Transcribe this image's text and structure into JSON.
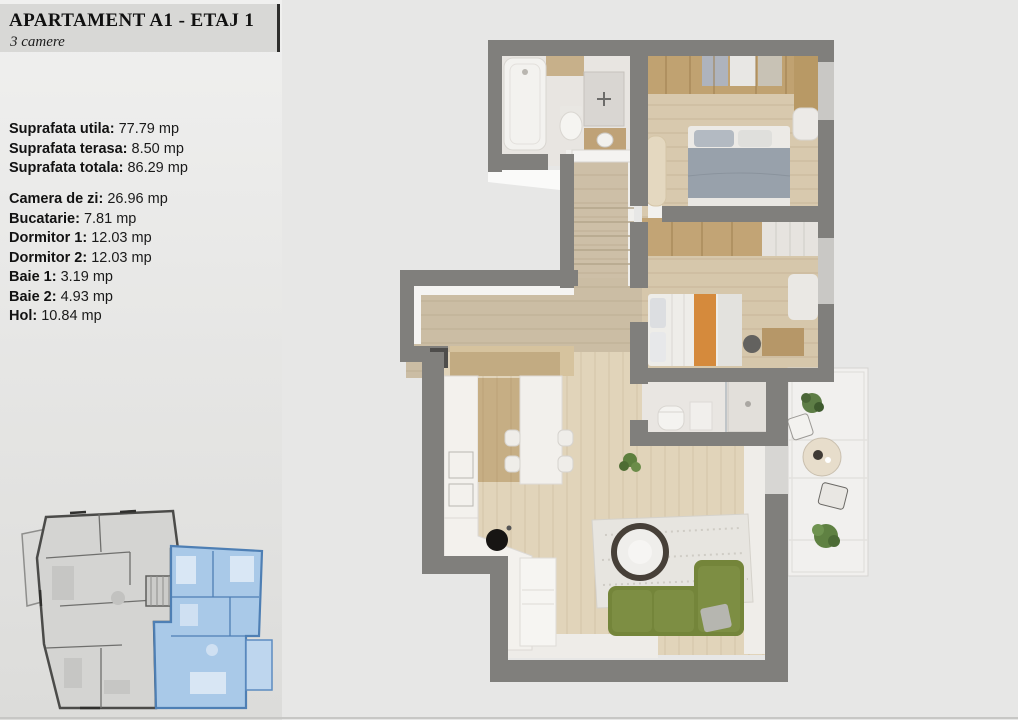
{
  "header": {
    "title": "APARTAMENT A1 - ETAJ 1",
    "subtitle": "3 camere"
  },
  "areas": {
    "summary": [
      {
        "label": "Suprafata utila:",
        "value": "77.79 mp"
      },
      {
        "label": "Suprafata terasa:",
        "value": "8.50 mp"
      },
      {
        "label": "Suprafata totala:",
        "value": "86.29 mp"
      }
    ],
    "rooms": [
      {
        "label": "Camera de zi:",
        "value": "26.96 mp"
      },
      {
        "label": "Bucatarie:",
        "value": "7.81 mp"
      },
      {
        "label": "Dormitor 1:",
        "value": "12.03 mp"
      },
      {
        "label": "Dormitor 2:",
        "value": "12.03 mp"
      },
      {
        "label": "Baie 1:",
        "value": "3.19 mp"
      },
      {
        "label": "Baie 2:",
        "value": "4.93 mp"
      },
      {
        "label": "Hol:",
        "value": "10.84 mp"
      }
    ]
  },
  "colors": {
    "wall_gray": "#807f7c",
    "wood_floor": "#d8c9ae",
    "hall_wood": "#cbbda4",
    "highlight_blue": "#a9c9e8",
    "highlight_blue_stroke": "#4e7fb4",
    "sofa_green": "#74853a",
    "accent_orange": "#d58a3c",
    "panel_bg": "#e9e9e8",
    "header_bar": "#d8d8d6"
  }
}
